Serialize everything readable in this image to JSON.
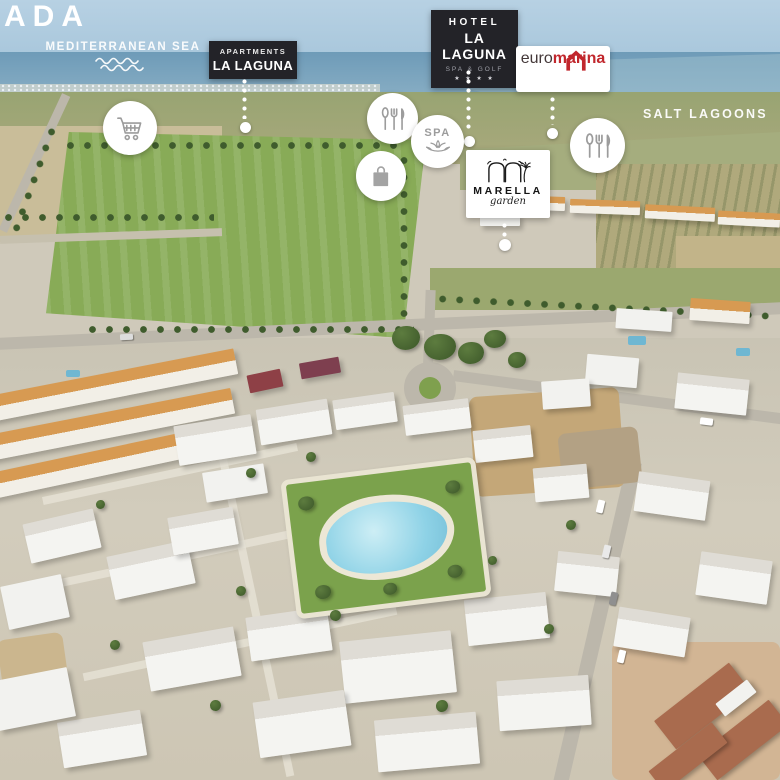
{
  "watermark": {
    "text": "ADA"
  },
  "labels": {
    "sea": "MEDITERRANEAN SEA",
    "salt_lagoons": "SALT LAGOONS"
  },
  "badges": {
    "apartments": {
      "line1": "APARTMENTS",
      "line2": "LA LAGUNA",
      "bg": "#232328",
      "text_color": "#ffffff"
    },
    "hotel": {
      "line1": "HOTEL",
      "line2": "LA LAGUNA",
      "line3": "SPA & GOLF",
      "stars": "★ ★ ★ ★",
      "bg": "#232328",
      "text_color": "#ffffff"
    },
    "euromarina": {
      "word1": "euro",
      "word2": "marina",
      "icon": "house-outline-icon",
      "accent_red": "#c1272d",
      "text_dark": "#443839",
      "bg": "#ffffff"
    }
  },
  "logo": {
    "name": "MARELLA",
    "sub": "garden",
    "icon": "arches-palm-icon",
    "bg": "#ffffff",
    "ink": "#141414"
  },
  "amenities": {
    "supermarket": {
      "icon": "shopping-cart-icon"
    },
    "restaurant_west": {
      "icon": "restaurant-cutlery-icon"
    },
    "spa": {
      "icon": "spa-lotus-icon",
      "label": "SPA"
    },
    "shopping": {
      "icon": "shopping-bag-icon"
    },
    "restaurant_east": {
      "icon": "restaurant-cutlery-icon"
    }
  },
  "scene_palette": {
    "sky": "#b7d1e3",
    "sea": "#6e9bb8",
    "lagoon": "#a7c6d4",
    "field_green": "#88ab57",
    "field_beige": "#c9bd99",
    "road": "#bcb7ab",
    "building_white": "#f2f2ef",
    "roof_terracotta": "#d79a52",
    "lawn": "#7ba24c",
    "pool_water": "#8ed2e6",
    "deck": "#ece7d6"
  }
}
